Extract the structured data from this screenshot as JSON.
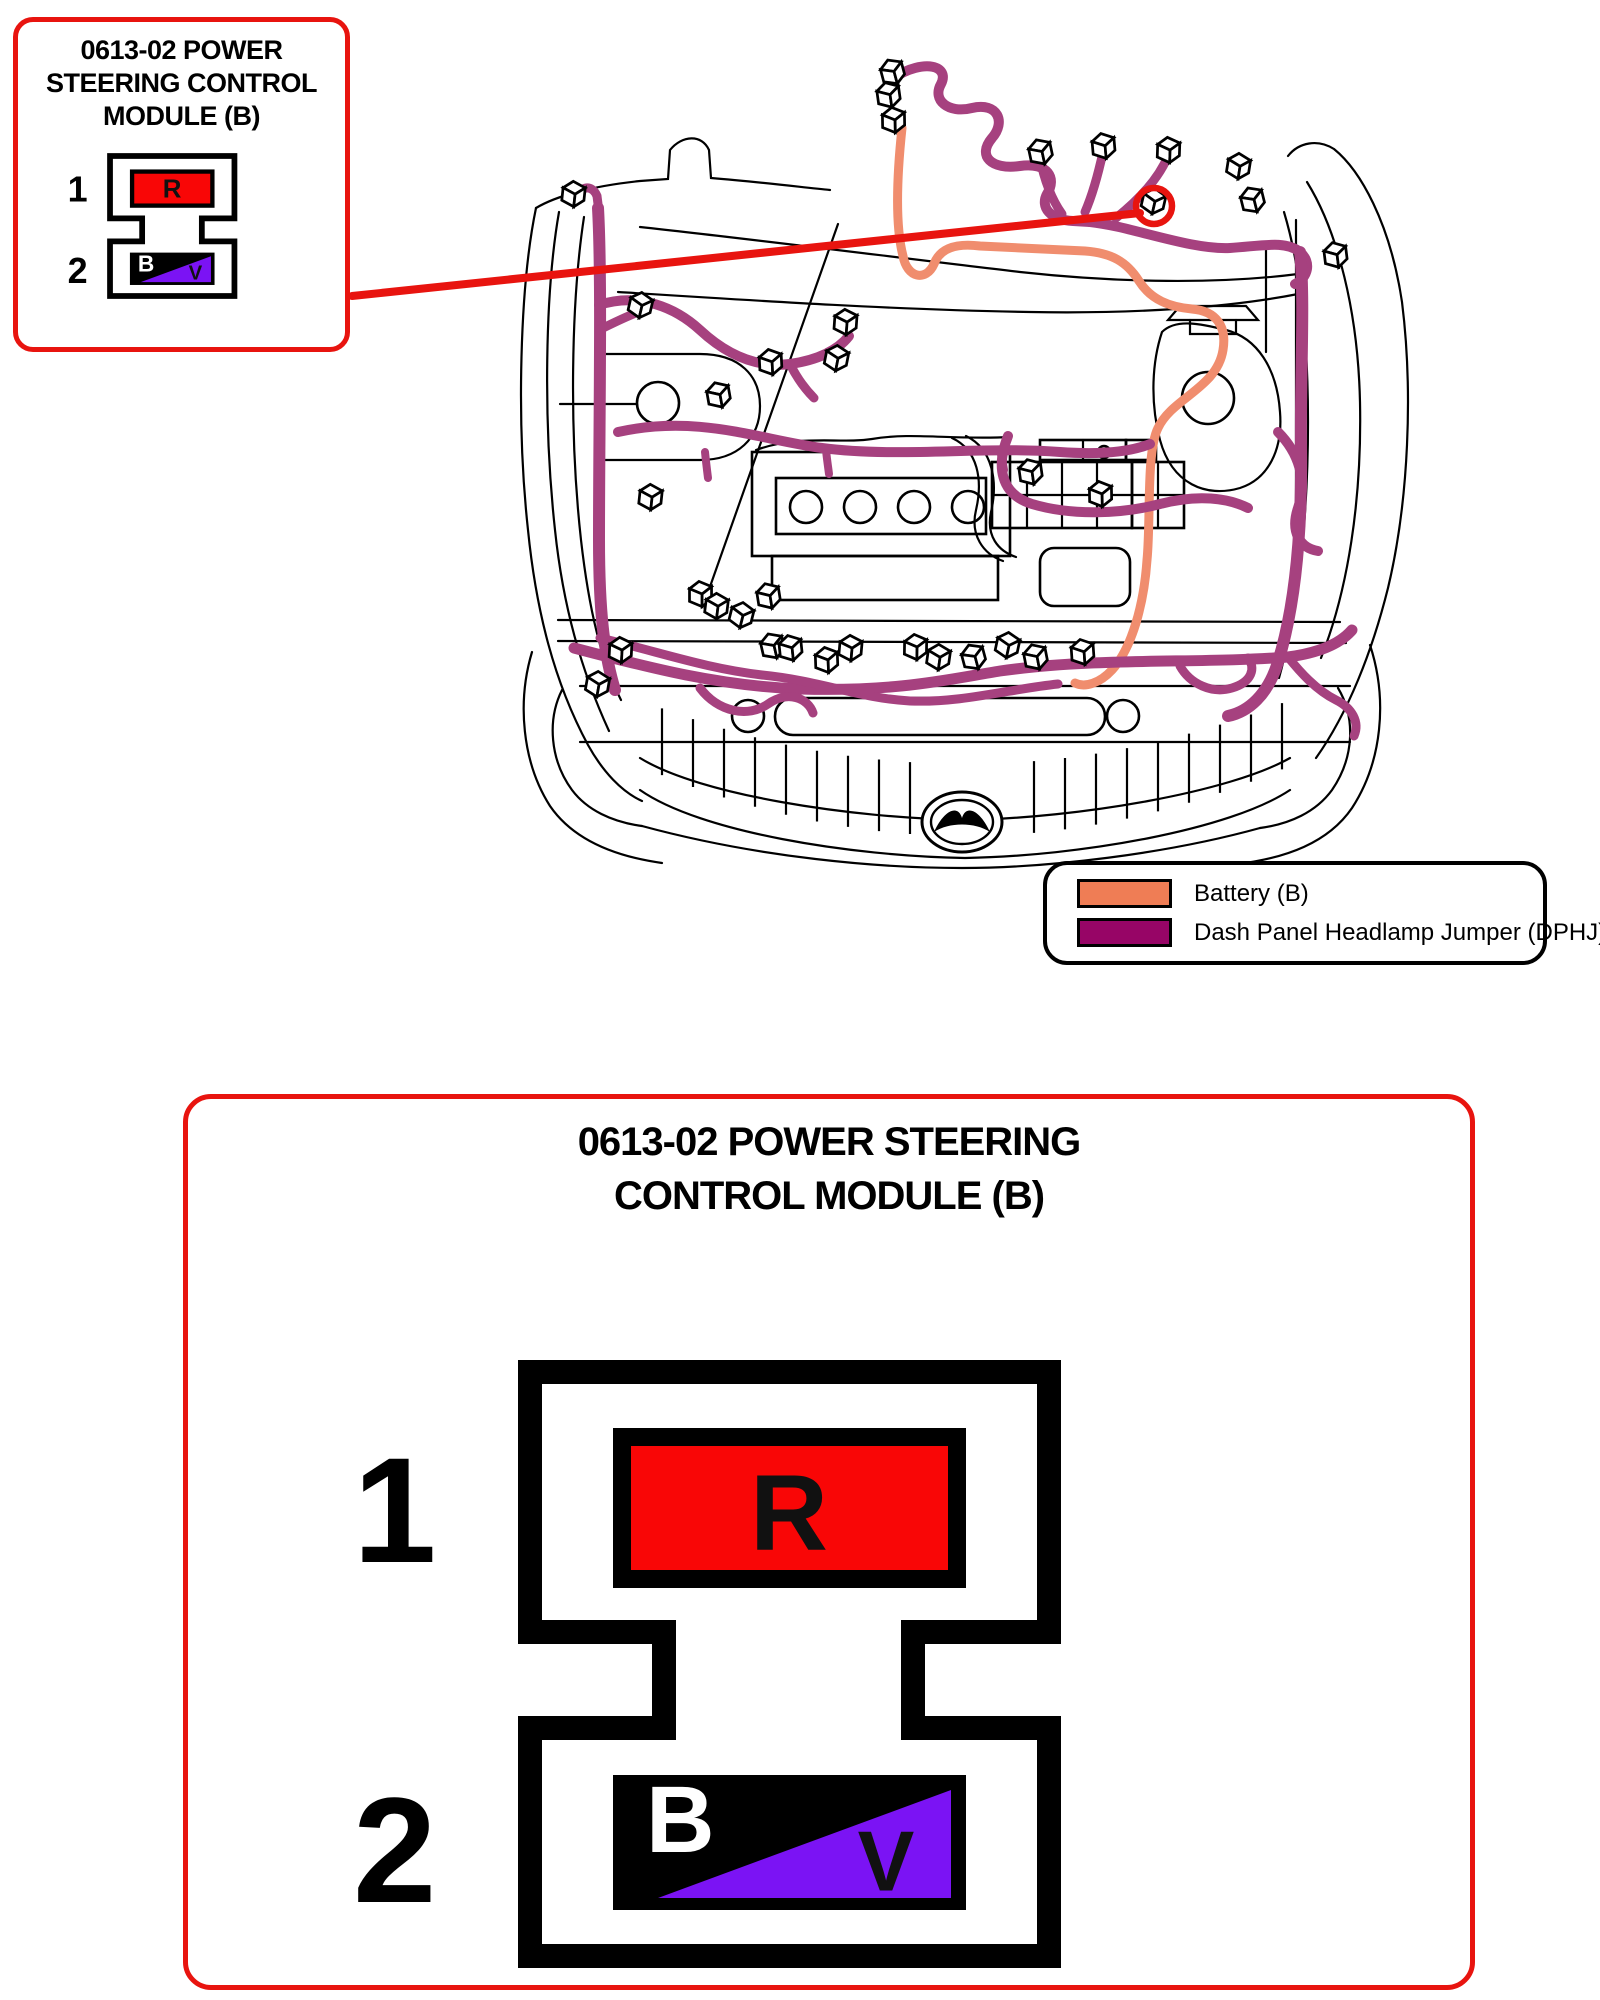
{
  "colors": {
    "accent_red": "#e8140f",
    "pin_red": "#f90606",
    "pin_violet": "#7b13f4",
    "pin_black": "#000000",
    "wire_purple": "#a6417f",
    "wire_orange": "#f08d6e",
    "legend_purple": "#970566",
    "legend_orange": "#ef7d55",
    "line_black": "#000000"
  },
  "callout": {
    "title_lines": [
      "0613-02 POWER",
      "STEERING CONTROL",
      "MODULE (B)"
    ]
  },
  "detail": {
    "title_lines": [
      "0613-02 POWER STEERING",
      "CONTROL MODULE (B)"
    ]
  },
  "connector": {
    "pins": [
      {
        "number": "1",
        "letter": "R",
        "wire": "Red"
      },
      {
        "number": "2",
        "letter_primary": "B",
        "letter_secondary": "V",
        "wire": "Black / Violet"
      }
    ]
  },
  "legend": {
    "items": [
      {
        "label": "Battery (B)",
        "color_key": "legend_orange"
      },
      {
        "label": "Dash Panel Headlamp Jumper (DPHJ)",
        "color_key": "legend_purple"
      }
    ]
  },
  "icons": [
    "connector-cube-icon",
    "highlight-circle-icon",
    "brand-emblem-icon"
  ]
}
